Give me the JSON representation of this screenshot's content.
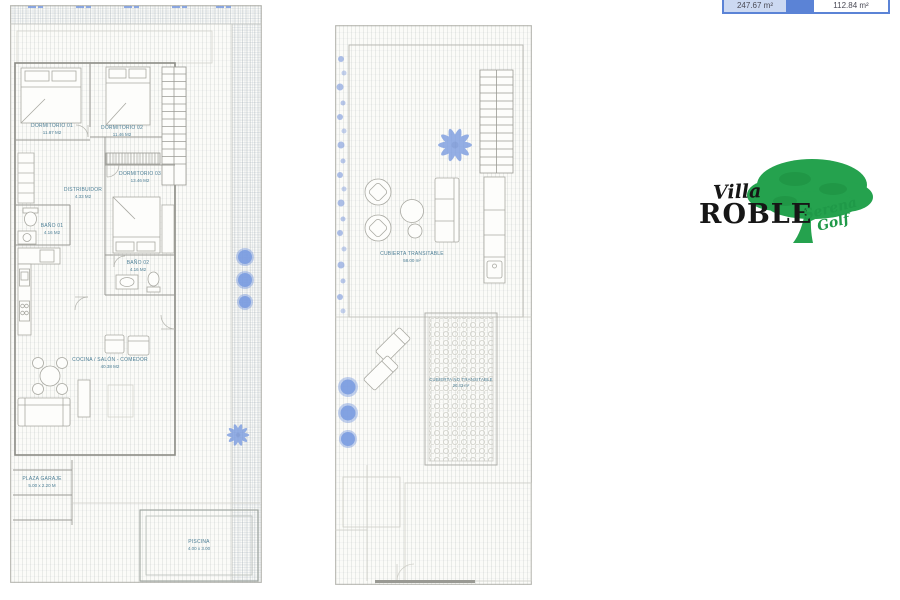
{
  "summary_table": {
    "left_value": "247.67 m²",
    "right_value": "112.84 m²"
  },
  "logo": {
    "villa": "Villa",
    "roble": "ROBLE",
    "serena": "Serena",
    "golf": "Golf"
  },
  "ground_floor": {
    "rooms": [
      {
        "label": "DORMITORIO 01",
        "area": "11.87 M2"
      },
      {
        "label": "DORMITORIO 02",
        "area": "11.46 M2"
      },
      {
        "label": "DORMITORIO 03",
        "area": "13.46 M2"
      },
      {
        "label": "DISTRIBUIDOR",
        "area": "4.33 M2"
      },
      {
        "label": "BAÑO 01",
        "area": "4.16 M2"
      },
      {
        "label": "BAÑO 02",
        "area": "4.16 M2"
      },
      {
        "label": "COCINA / SALÓN - COMEDOR",
        "area": "40.38 M2"
      },
      {
        "label": "PLAZA GARAJE",
        "area": "5.00 x 2.20 M"
      },
      {
        "label": "PISCINA",
        "area": "4.00 x 3.00"
      }
    ]
  },
  "roof_plan": {
    "rooms": [
      {
        "label": "CUBIERTA TRANSITABLE",
        "area": "58.00 m²"
      },
      {
        "label": "CUBIERTA NO TRANSITABLE",
        "area": "20.43 m²"
      }
    ]
  },
  "colors": {
    "accent_blue": "#5b83d6",
    "table_cell_blue": "#ccd9f2",
    "plan_text": "#4d7f96",
    "logo_green": "#21a14b",
    "plant_blue": "#7b9ce0"
  }
}
